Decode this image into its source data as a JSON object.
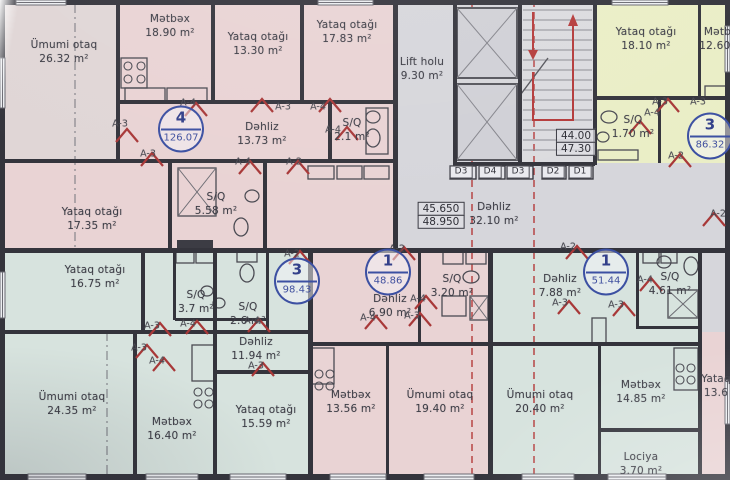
{
  "plan_title": "Mərtəbə planı",
  "rooms": [
    {
      "name": "Ümumi otaq",
      "area": "26.32 m²",
      "x": 64,
      "y": 38
    },
    {
      "name": "Mətbəx",
      "area": "18.90 m²",
      "x": 170,
      "y": 12
    },
    {
      "name": "Yataq otağı",
      "area": "13.30 m²",
      "x": 258,
      "y": 30
    },
    {
      "name": "Yataq otağı",
      "area": "17.83 m²",
      "x": 347,
      "y": 18
    },
    {
      "name": "Lift holu",
      "area": "9.30 m²",
      "x": 422,
      "y": 55
    },
    {
      "name": "Yataq otağı",
      "area": "18.10 m²",
      "x": 646,
      "y": 25
    },
    {
      "name": "Mətbəx",
      "area": "12.60 m²",
      "x": 724,
      "y": 25
    },
    {
      "name": "Dəhliz",
      "area": "13.73 m²",
      "x": 262,
      "y": 120
    },
    {
      "name": "S/Q",
      "area": "2.1 m²",
      "x": 352,
      "y": 116
    },
    {
      "name": "S/Q",
      "area": "5.58 m²",
      "x": 216,
      "y": 190
    },
    {
      "name": "Yataq otağı",
      "area": "17.35 m²",
      "x": 92,
      "y": 205
    },
    {
      "name": "Dəhliz",
      "area": "32.10 m²",
      "x": 494,
      "y": 200
    },
    {
      "name": "S/Q",
      "area": "1.70 m²",
      "x": 633,
      "y": 113
    },
    {
      "name": "Yataq otağı",
      "area": "16.75 m²",
      "x": 95,
      "y": 263
    },
    {
      "name": "S/Q",
      "area": "3.7 m²",
      "x": 196,
      "y": 288
    },
    {
      "name": "S/Q",
      "area": "2.6 m²",
      "x": 248,
      "y": 300
    },
    {
      "name": "Dəhliz",
      "area": "11.94 m²",
      "x": 256,
      "y": 335
    },
    {
      "name": "Dəhliz",
      "area": "6.90 m²",
      "x": 390,
      "y": 292
    },
    {
      "name": "S/Q",
      "area": "3.20 m²",
      "x": 452,
      "y": 272
    },
    {
      "name": "Dəhliz",
      "area": "7.88 m²",
      "x": 560,
      "y": 272
    },
    {
      "name": "S/Q",
      "area": "4.61 m²",
      "x": 670,
      "y": 270
    },
    {
      "name": "Ümumi otaq",
      "area": "24.35 m²",
      "x": 72,
      "y": 390
    },
    {
      "name": "Mətbəx",
      "area": "16.40 m²",
      "x": 172,
      "y": 415
    },
    {
      "name": "Yataq otağı",
      "area": "15.59 m²",
      "x": 266,
      "y": 403
    },
    {
      "name": "Mətbəx",
      "area": "13.56 m²",
      "x": 351,
      "y": 388
    },
    {
      "name": "Ümumi otaq",
      "area": "19.40 m²",
      "x": 440,
      "y": 388
    },
    {
      "name": "Ümumi otaq",
      "area": "20.40 m²",
      "x": 540,
      "y": 388
    },
    {
      "name": "Mətbəx",
      "area": "14.85 m²",
      "x": 641,
      "y": 378
    },
    {
      "name": "Lociya",
      "area": "3.70 m²",
      "x": 641,
      "y": 450
    },
    {
      "name": "Yataq",
      "area": "13.6",
      "x": 716,
      "y": 372
    }
  ],
  "badges": [
    {
      "num": "4",
      "total": "126.07",
      "x": 181,
      "y": 129
    },
    {
      "num": "3",
      "total": "86.32",
      "x": 710,
      "y": 136
    },
    {
      "num": "3",
      "total": "98.43",
      "x": 297,
      "y": 281
    },
    {
      "num": "1",
      "total": "48.86",
      "x": 388,
      "y": 272
    },
    {
      "num": "1",
      "total": "51.44",
      "x": 606,
      "y": 272
    }
  ],
  "levels": [
    {
      "top": "44.00",
      "bottom": "47.30",
      "x": 576,
      "y": 143
    },
    {
      "top": "45.650",
      "bottom": "48.950",
      "x": 441,
      "y": 216
    }
  ],
  "d_labels": [
    {
      "t": "D3",
      "x": 461,
      "y": 172
    },
    {
      "t": "D4",
      "x": 490,
      "y": 172
    },
    {
      "t": "D3",
      "x": 518,
      "y": 172
    },
    {
      "t": "D2",
      "x": 553,
      "y": 172
    },
    {
      "t": "D1",
      "x": 580,
      "y": 172
    }
  ],
  "a_labels": [
    {
      "t": "A-4",
      "x": 188,
      "y": 103
    },
    {
      "t": "A-3",
      "x": 120,
      "y": 124
    },
    {
      "t": "A-3",
      "x": 148,
      "y": 154
    },
    {
      "t": "A-3",
      "x": 283,
      "y": 107
    },
    {
      "t": "A-4",
      "x": 318,
      "y": 107
    },
    {
      "t": "A-4",
      "x": 333,
      "y": 130
    },
    {
      "t": "A-4",
      "x": 243,
      "y": 162
    },
    {
      "t": "A-2",
      "x": 294,
      "y": 162
    },
    {
      "t": "A-3",
      "x": 660,
      "y": 102
    },
    {
      "t": "A-3",
      "x": 698,
      "y": 102
    },
    {
      "t": "A-4",
      "x": 652,
      "y": 113
    },
    {
      "t": "A-2",
      "x": 676,
      "y": 156
    },
    {
      "t": "A-2",
      "x": 718,
      "y": 214
    },
    {
      "t": "A-2",
      "x": 568,
      "y": 247
    },
    {
      "t": "A-2",
      "x": 292,
      "y": 254
    },
    {
      "t": "A-2",
      "x": 397,
      "y": 249
    },
    {
      "t": "A-3",
      "x": 152,
      "y": 326
    },
    {
      "t": "A-4",
      "x": 188,
      "y": 324
    },
    {
      "t": "A-3",
      "x": 139,
      "y": 348
    },
    {
      "t": "A-4",
      "x": 157,
      "y": 361
    },
    {
      "t": "A-4",
      "x": 252,
      "y": 321
    },
    {
      "t": "A-3",
      "x": 256,
      "y": 366
    },
    {
      "t": "A-4",
      "x": 418,
      "y": 299
    },
    {
      "t": "A-3",
      "x": 412,
      "y": 316
    },
    {
      "t": "A-4",
      "x": 368,
      "y": 318
    },
    {
      "t": "A-4",
      "x": 645,
      "y": 280
    },
    {
      "t": "A-3",
      "x": 560,
      "y": 303
    },
    {
      "t": "A-3",
      "x": 616,
      "y": 305
    }
  ]
}
